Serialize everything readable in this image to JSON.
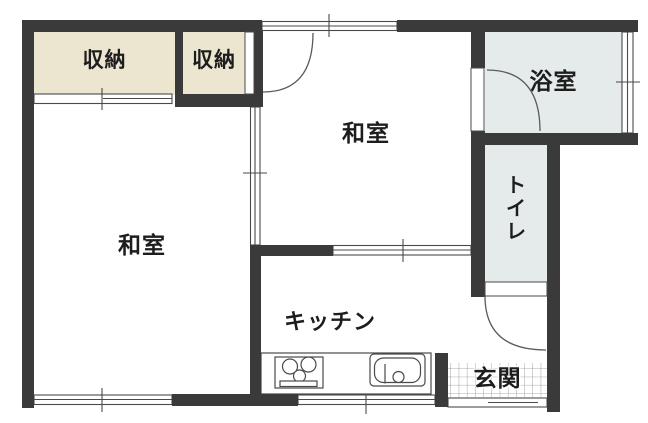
{
  "plan": {
    "title": "apartment-floor-plan",
    "colors": {
      "wall": "#3a3a3a",
      "closet_fill": "#ece5d0",
      "wet_room_fill": "#e4ebea",
      "line": "#4a4a4a",
      "arc": "#5a5a5a",
      "grid": "#8f8f8f",
      "text": "#1d1d1d",
      "floor": "#ffffff"
    },
    "rooms": {
      "closet1": {
        "label": "収納"
      },
      "closet2": {
        "label": "収納"
      },
      "washitsu_top": {
        "label": "和室"
      },
      "washitsu_left": {
        "label": "和室"
      },
      "bathroom": {
        "label": "浴室"
      },
      "toilet": {
        "label": "トイレ"
      },
      "kitchen": {
        "label": "キッチン"
      },
      "entrance": {
        "label": "玄関"
      }
    }
  }
}
